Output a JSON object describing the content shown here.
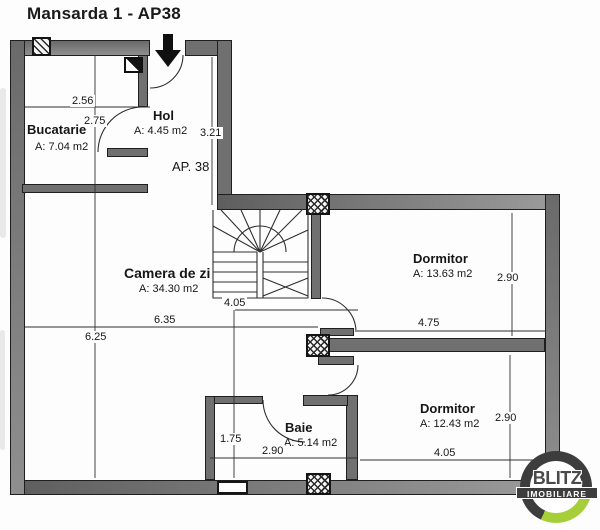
{
  "title": "Mansarda 1 - AP38",
  "plan": {
    "apartment_label": "AP. 38",
    "rooms": {
      "bucatarie": {
        "name": "Bucatarie",
        "area": "A: 7.04 m2"
      },
      "hol": {
        "name": "Hol",
        "area": "A: 4.45 m2"
      },
      "camera_de_zi": {
        "name": "Camera de zi",
        "area": "A: 34.30 m2"
      },
      "dormitor1": {
        "name": "Dormitor",
        "area": "A: 13.63 m2"
      },
      "dormitor2": {
        "name": "Dormitor",
        "area": "A: 12.43 m2"
      },
      "baie": {
        "name": "Baie",
        "area": "A: 5.14 m2"
      }
    },
    "dimensions": {
      "kitchen_width": "2.56",
      "kitchen_height": "2.75",
      "hol_height": "3.21",
      "living_width": "6.35",
      "living_height": "6.25",
      "stair_span": "4.05",
      "dorm1_width": "4.75",
      "dorm1_height": "2.90",
      "dorm2_width": "4.05",
      "dorm2_height": "2.90",
      "baie_width": "2.90",
      "baie_height": "1.75"
    }
  },
  "logo": {
    "line1": "BLITZ",
    "line2": "IMOBILIARE"
  },
  "colors": {
    "wall_gray": "#707070",
    "plan_line": "#2f2f2f",
    "logo_ring": "#3d3d3d",
    "logo_accent": "#a6ce39"
  }
}
